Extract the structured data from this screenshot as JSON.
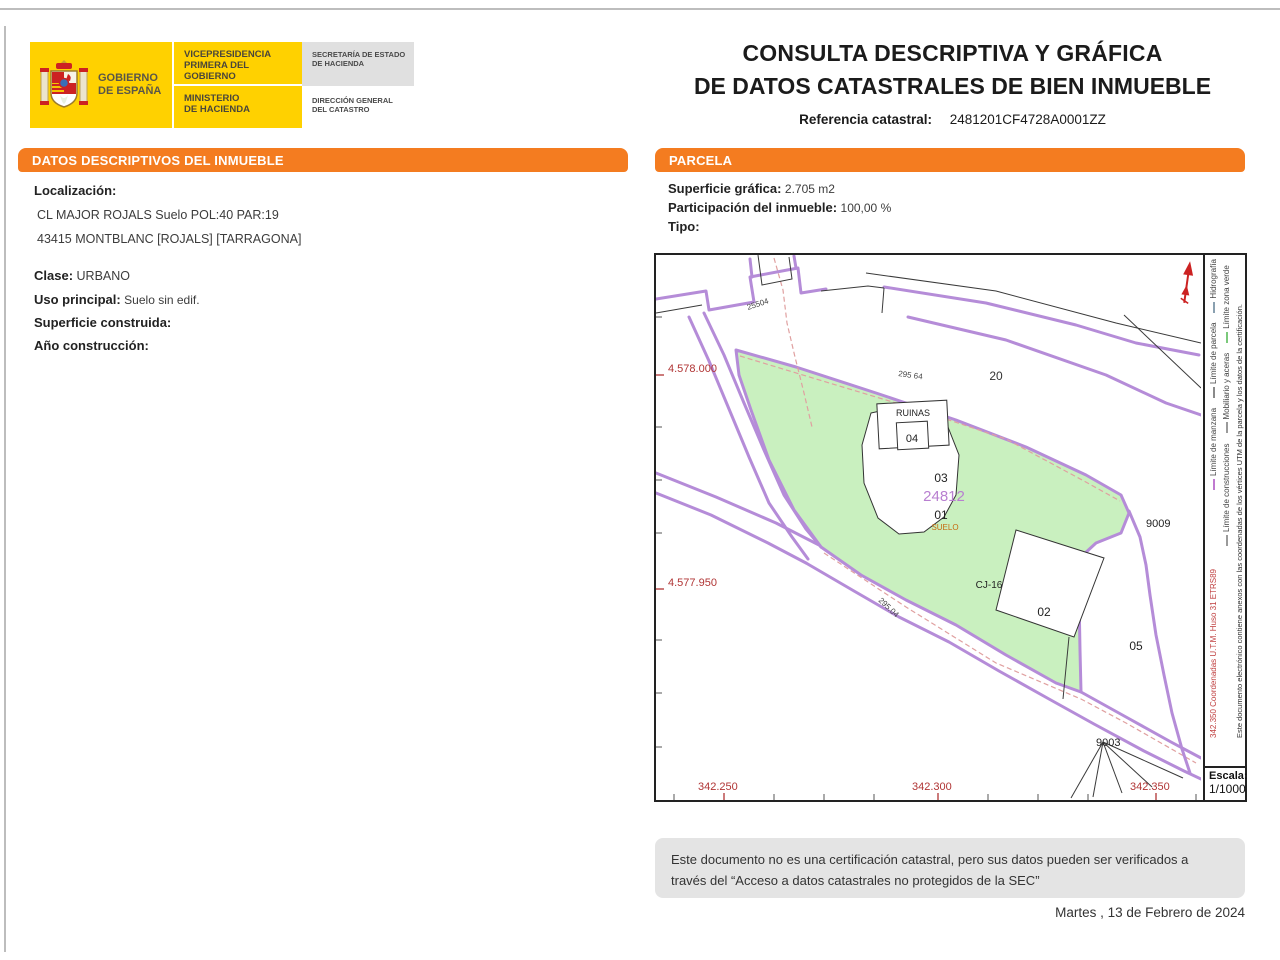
{
  "theme": {
    "accent_orange": "#f47c20",
    "yellow": "#ffd100",
    "map_green": "#c9f0bf",
    "map_purple": "#b58cd8",
    "map_red": "#b03434"
  },
  "header": {
    "logo": {
      "gobierno_lines": [
        "GOBIERNO",
        "DE ESPAÑA"
      ],
      "vicepresidencia_lines": [
        "VICEPRESIDENCIA",
        "PRIMERA DEL GOBIERNO"
      ],
      "ministerio_lines": [
        "MINISTERIO",
        "DE HACIENDA"
      ],
      "secretaria_lines": [
        "SECRETARÍA DE ESTADO",
        "DE HACIENDA"
      ],
      "direccion_lines": [
        "DIRECCIÓN GENERAL",
        "DEL CATASTRO"
      ]
    },
    "title_line1": "CONSULTA DESCRIPTIVA Y GRÁFICA",
    "title_line2": "DE DATOS CATASTRALES DE BIEN INMUEBLE",
    "ref_label": "Referencia catastral:",
    "ref_value": "2481201CF4728A0001ZZ"
  },
  "datos": {
    "section_title": "DATOS DESCRIPTIVOS DEL INMUEBLE",
    "localizacion_label": "Localización:",
    "address_line1": "CL MAJOR ROJALS  Suelo POL:40 PAR:19",
    "address_line2": "43415 MONTBLANC [ROJALS] [TARRAGONA]",
    "clase_label": "Clase:",
    "clase_value": "URBANO",
    "uso_label": "Uso principal:",
    "uso_value": "Suelo sin edif.",
    "superficie_label": "Superficie construida:",
    "superficie_value": "",
    "ano_label": "Año construcción:",
    "ano_value": ""
  },
  "parcela": {
    "section_title": "PARCELA",
    "superficie_label": "Superficie gráfica:",
    "superficie_value": "2.705 m2",
    "participacion_label": "Participación del inmueble:",
    "participacion_value": "100,00 %",
    "tipo_label": "Tipo:",
    "tipo_value": ""
  },
  "map": {
    "escala_label": "Escala:",
    "escala_value": "1/1000",
    "sidebar": {
      "coord_note_red": "342.350  Coordenadas U.T.M. Huso 31 ETRS89",
      "doc_note": "Este documento electrónico contiene anexos con las coordenadas de los vértices UTM de la parcela y los datos de la certificación.",
      "legend_rows": [
        [
          {
            "color": "#c07ad0",
            "label": "Límite de manzana"
          },
          {
            "color": "#8a8a8a",
            "label": "Límite de parcela"
          },
          {
            "color": "#8aa0b0",
            "label": "Hidrografía"
          }
        ],
        [
          {
            "color": "#9a9a9a",
            "label": "Límite de construcciones"
          },
          {
            "color": "#9a9a9a",
            "label": "Mobiliario y aceras"
          },
          {
            "color": "#7bc97b",
            "label": "Límite zona verde"
          }
        ]
      ]
    },
    "labels": [
      {
        "text": "20",
        "x": 340,
        "y": 125,
        "size": 12,
        "color": "#333",
        "anchor": "middle"
      },
      {
        "text": "RUINAS",
        "x": 257,
        "y": 161,
        "size": 9,
        "color": "#222",
        "anchor": "middle"
      },
      {
        "text": "04",
        "x": 256,
        "y": 187,
        "size": 11,
        "color": "#222",
        "anchor": "middle"
      },
      {
        "text": "03",
        "x": 285,
        "y": 227,
        "size": 12,
        "color": "#222",
        "anchor": "middle"
      },
      {
        "text": "24812",
        "x": 288,
        "y": 246,
        "size": 15,
        "color": "#b87fd0",
        "anchor": "middle"
      },
      {
        "text": "01",
        "x": 285,
        "y": 264,
        "size": 12,
        "color": "#222",
        "anchor": "middle"
      },
      {
        "text": "SUELO",
        "x": 289,
        "y": 275,
        "size": 8,
        "color": "#c66a10",
        "anchor": "middle"
      },
      {
        "text": "CJ-16",
        "x": 333,
        "y": 333,
        "size": 10,
        "color": "#222",
        "anchor": "middle"
      },
      {
        "text": "02",
        "x": 388,
        "y": 361,
        "size": 12,
        "color": "#222",
        "anchor": "middle"
      },
      {
        "text": "05",
        "x": 480,
        "y": 395,
        "size": 12,
        "color": "#222",
        "anchor": "middle"
      },
      {
        "text": "9009",
        "x": 490,
        "y": 272,
        "size": 11,
        "color": "#222"
      },
      {
        "text": "9003",
        "x": 440,
        "y": 491,
        "size": 11,
        "color": "#222"
      },
      {
        "text": "25504",
        "x": 92,
        "y": 55,
        "size": 8,
        "color": "#444",
        "rotate": -18
      },
      {
        "text": "295 64",
        "x": 242,
        "y": 121,
        "size": 8,
        "color": "#444",
        "rotate": 8
      },
      {
        "text": "295.04",
        "x": 222,
        "y": 346,
        "size": 8,
        "color": "#444",
        "rotate": 43
      },
      {
        "text": "4.578.000",
        "x": 12,
        "y": 117,
        "size": 11,
        "color": "#b03434"
      },
      {
        "text": "4.577.950",
        "x": 12,
        "y": 331,
        "size": 11,
        "color": "#b03434"
      },
      {
        "text": "342.250",
        "x": 42,
        "y": 535,
        "size": 11,
        "color": "#b03434"
      },
      {
        "text": "342.300",
        "x": 256,
        "y": 535,
        "size": 11,
        "color": "#b03434"
      },
      {
        "text": "342.350",
        "x": 474,
        "y": 535,
        "size": 11,
        "color": "#b03434"
      }
    ]
  },
  "footer": {
    "disclaimer_line1": "Este documento no es una certificación catastral, pero sus datos pueden ser verificados a",
    "disclaimer_line2": "través del “Acceso a datos catastrales no protegidos de la SEC”",
    "date": "Martes , 13 de Febrero de 2024"
  }
}
